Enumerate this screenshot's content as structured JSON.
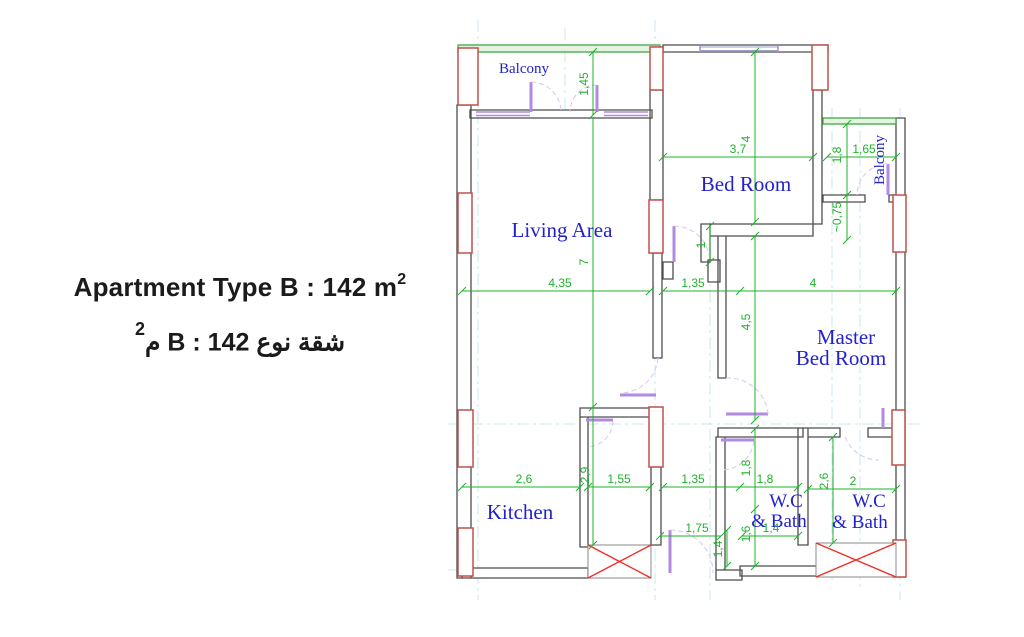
{
  "title": {
    "english_main": "Apartment Type B : 142 m",
    "english_sup": "2",
    "arabic_main": "شقة نوع B  :  142 م",
    "arabic_sup": "2"
  },
  "rooms": {
    "balcony_top": "Balcony",
    "living": "Living Area",
    "bedroom": "Bed Room",
    "balcony_right": "Balcony",
    "master_line1": "Master",
    "master_line2": "Bed Room",
    "kitchen": "Kitchen",
    "wc_left_line1": "W.C",
    "wc_left_line2": "& Bath",
    "wc_right_line1": "W.C",
    "wc_right_line2": "& Bath"
  },
  "dims": {
    "balcony_height": "1,45",
    "living_width": "4,35",
    "living_height": "7",
    "hall_width": "1,35",
    "hall_door_width": "1",
    "bedroom_width": "3,7",
    "bedroom_height": "4",
    "balcony_right_height": "1,8",
    "balcony_right_width": "1,65",
    "balcony_right_offset": "~0,75",
    "master_width": "4",
    "master_height": "4,5",
    "kitchen_width": "2,6",
    "kitchen_height": "2,9",
    "pantry_width": "1,55",
    "hall_width_lower": "1,35",
    "wc_left_height": "1,8",
    "wc_left_width": "1,8",
    "wc_left_lower_height": "1,6",
    "wc_left_lower_width": "1,4",
    "wc_right_height": "2,6",
    "wc_right_width": "2",
    "entrance_width": "1,75",
    "entry_depth": "1,4"
  },
  "colors": {
    "room_label_blue": "#2222cc",
    "dimension_green": "#1db32a",
    "column_red": "#c0504a",
    "shaft_x_red": "#ee2e24",
    "door_purple": "#b28ae0",
    "wall_gray": "#4d4d4d",
    "centerline_cyan": "#c9e9ec",
    "balcony_wall_green": "#3aa33d"
  }
}
